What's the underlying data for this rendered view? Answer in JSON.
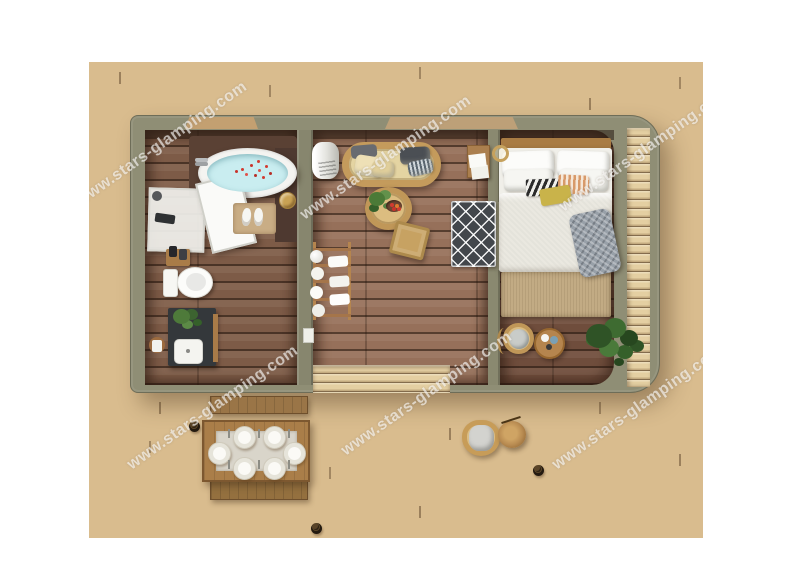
{
  "watermark": {
    "text": "www.stars-glamping.com"
  },
  "colors": {
    "background": "#ffffff",
    "deck_plank": "#d9bc8e",
    "deck_gap": "#7a5c3d",
    "cabin_wall": "#8f8e75",
    "bathroom_floor": "#7d5b47",
    "living_floor": "#96705a",
    "bedroom_floor": "#6f4d3c",
    "bath_water": "#c9edf0",
    "petal_red": "#d23b30",
    "rug_dark": "#43474c",
    "rattan": "#c49b5c",
    "bed_linen": "#eae8e0",
    "throw_gray": "#98a0a8"
  },
  "scene": {
    "view": "top-down cabin floor plan render on wooden deck",
    "rooms": [
      {
        "name": "bathroom",
        "objects": [
          "bathtub-with-petals",
          "shower-enclosure",
          "toilet",
          "vanity-sink",
          "potted-plant",
          "bath-mat-slippers",
          "towel-ring",
          "wall-tray"
        ]
      },
      {
        "name": "living-room",
        "objects": [
          "rattan-sofa",
          "cushions",
          "round-coffee-table",
          "fruit-bowl",
          "square-floor-tray",
          "geometric-rug",
          "towel-ladder-rack",
          "white-cylinder-unit",
          "writing-desk"
        ]
      },
      {
        "name": "bedroom",
        "objects": [
          "double-bed",
          "pillows",
          "knit-throw",
          "table-lamp",
          "foot-rug",
          "rattan-stool",
          "round-side-table",
          "fiddle-leaf-plant"
        ]
      }
    ],
    "deck_objects": [
      "dining-table",
      "table-runner",
      "dinner-plates",
      "bench-upper",
      "bench-lower",
      "lounge-chair",
      "stump-side-table",
      "deck-lights"
    ]
  }
}
